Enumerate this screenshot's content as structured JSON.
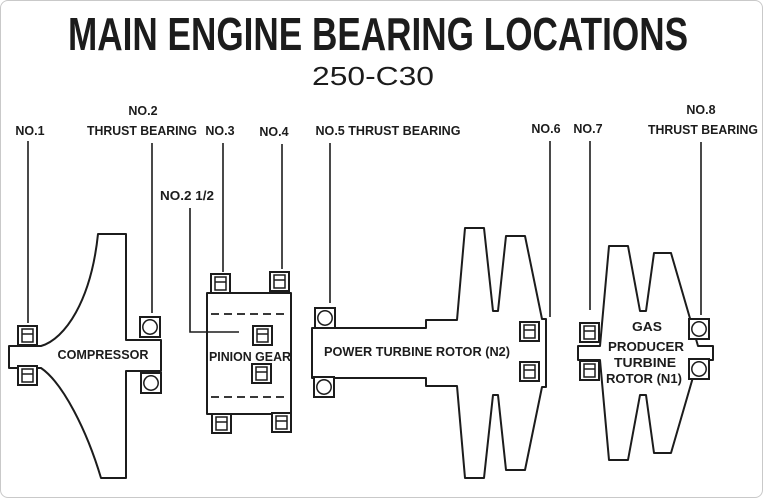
{
  "title": "MAIN ENGINE BEARING LOCATIONS",
  "subtitle": "250-C30",
  "callouts": {
    "no1": "NO.1",
    "no2_line1": "NO.2",
    "no2_line2": "THRUST BEARING",
    "no2_half": "NO.2 1/2",
    "no3": "NO.3",
    "no4": "NO.4",
    "no5": "NO.5 THRUST BEARING",
    "no6": "NO.6",
    "no7": "NO.7",
    "no8_line1": "NO.8",
    "no8_line2": "THRUST BEARING"
  },
  "components": {
    "compressor": "COMPRESSOR",
    "pinion_gear": "PINION GEAR",
    "power_turbine": "POWER TURBINE ROTOR (N2)",
    "gas_producer_line1": "GAS",
    "gas_producer_line2": "PRODUCER",
    "gas_producer_line3": "TURBINE",
    "gas_producer_line4": "ROTOR (N1)"
  },
  "colors": {
    "ink": "#1c1c1c",
    "background": "#ffffff"
  }
}
